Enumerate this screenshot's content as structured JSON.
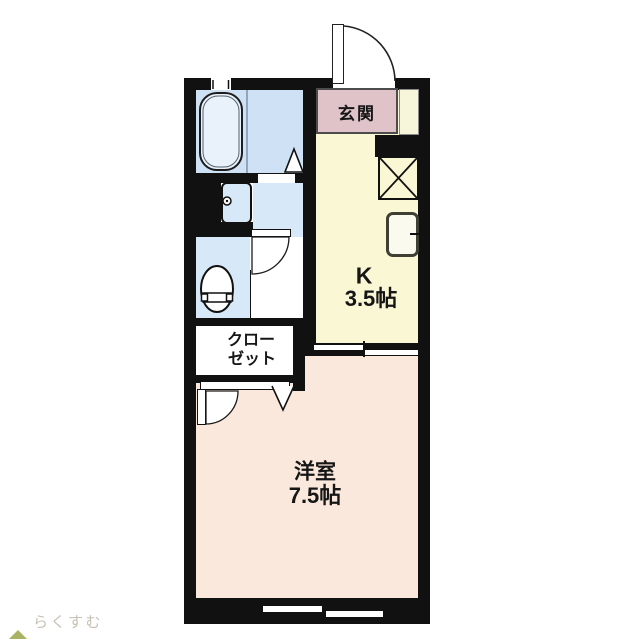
{
  "plan": {
    "labels": {
      "genkan": "玄関",
      "kitchen_name": "K",
      "kitchen_size": "3.5帖",
      "closet_line1": "クロー",
      "closet_line2": "ゼット",
      "room_name": "洋室",
      "room_size": "7.5帖"
    },
    "colors": {
      "wall": "#111111",
      "bathroom_floor": "#cfe2f5",
      "sanitary_floor": "#d7e8f8",
      "bathtub_fill": "#e9f2fb",
      "kitchen_floor": "#f9f7d4",
      "genkan_floor": "#dfc3c9",
      "western_room_floor": "#fae8dc",
      "closet_floor": "#ffffff",
      "shoe_cabinet": "#f7f5da"
    },
    "fixtures": [
      "bathtub",
      "washbasin",
      "toilet",
      "kitchen-sink",
      "refrigerator-space",
      "entrance-door",
      "bathroom-door",
      "toilet-door",
      "room-door",
      "closet-door",
      "sliding-door",
      "small-window-top",
      "sliding-window-bottom"
    ]
  },
  "logo": {
    "text": "らくすむ",
    "text_color": "#c8bfb4",
    "roof_color": "#a9b363",
    "base_color": "#8f8f8f"
  }
}
